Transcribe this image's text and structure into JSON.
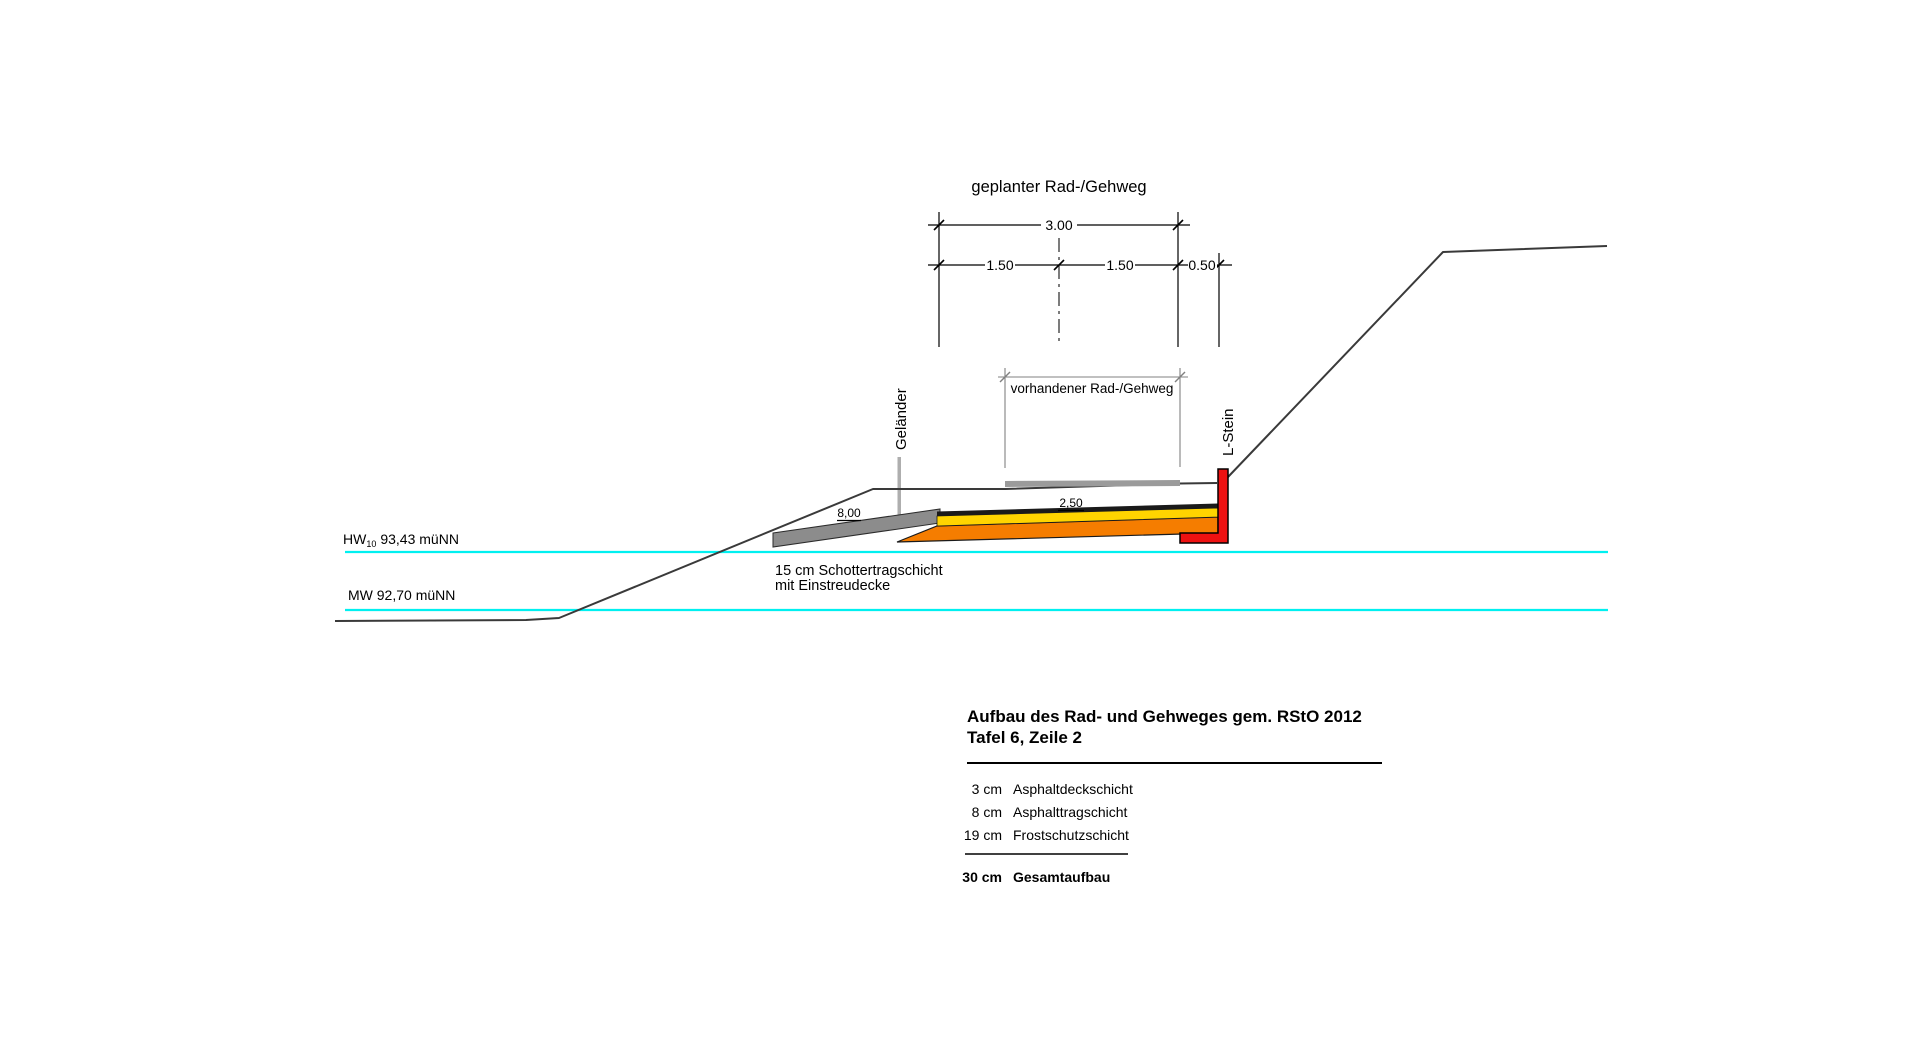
{
  "drawing": {
    "title": "geplanter Rad-/Gehweg"
  },
  "dimensions": {
    "total_width": "3.00",
    "lane_left": "1.50",
    "lane_right": "1.50",
    "edge_strip": "0.50",
    "existing_path": "vorhandener Rad-/Gehweg"
  },
  "annotations": {
    "railing": "Geländer",
    "l_stone": "L-Stein",
    "ramp_slope": "8,00",
    "path_slope": "2,50",
    "gravel_line1": "15 cm Schottertragschicht",
    "gravel_line2": "mit Einstreudecke"
  },
  "water_levels": {
    "hw_name": "HW",
    "hw_index": "10",
    "hw_value": "93,43 müNN",
    "mw_label": "MW 92,70 müNN"
  },
  "buildup_table": {
    "title_line1": "Aufbau des Rad- und Gehweges gem. RStO 2012",
    "title_line2": "Tafel 6, Zeile 2",
    "rows": [
      {
        "thickness": "3 cm",
        "layer": "Asphaltdeckschicht"
      },
      {
        "thickness": "8 cm",
        "layer": "Asphalttragschicht"
      },
      {
        "thickness": "19 cm",
        "layer": "Frostschutzschicht"
      }
    ],
    "total_thickness": "30 cm",
    "total_layer": "Gesamtaufbau"
  },
  "colors": {
    "water": "#00f0f0",
    "frost_protection_layer": "#f57d00",
    "asphalt_base_layer": "#ffd400",
    "asphalt_surface": "#1a1a1a",
    "l_stone_concrete": "#ee1111",
    "gravel_ramp": "#8c8c8c",
    "existing_surface": "#9b9b9b",
    "secondary_dim": "#808080"
  }
}
